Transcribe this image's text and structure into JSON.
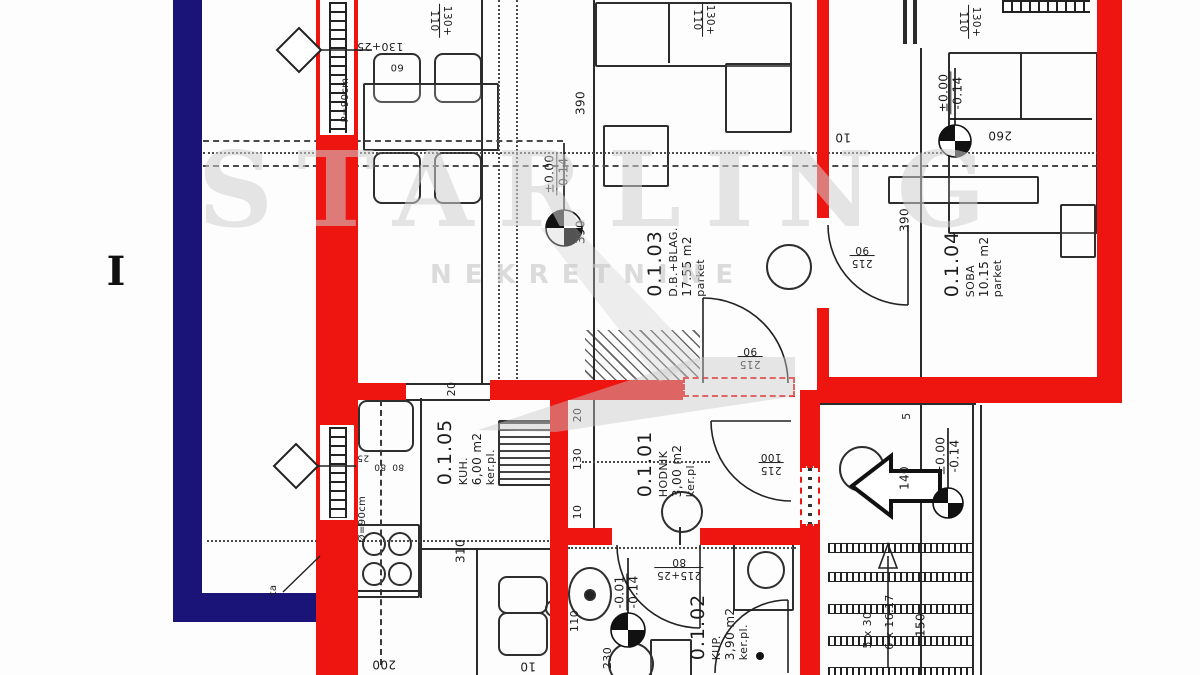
{
  "watermark": {
    "line1": "STARLING",
    "line2": "NEKRETNINE"
  },
  "floor_label": "I",
  "colors": {
    "wall_new": "#ee1511",
    "wall_existing": "#1b1478",
    "line": "#2b2b2b",
    "paper": "#fdfdfd"
  },
  "rooms": [
    {
      "id": "0.1.01",
      "name": "HODNIK",
      "area": "3,00 m2",
      "floor": "ker.pl.",
      "x": 666,
      "y": 464
    },
    {
      "id": "0.1.02",
      "name": "KUP.",
      "area": "3,90 m2",
      "floor": "ker.pl.",
      "x": 719,
      "y": 627
    },
    {
      "id": "0.1.03",
      "name": "D.B.+BLAG.",
      "area": "17.55 m2",
      "floor": "parket",
      "x": 676,
      "y": 262
    },
    {
      "id": "0.1.04",
      "name": "SOBA",
      "area": "10.15 m2",
      "floor": "parket",
      "x": 973,
      "y": 264
    },
    {
      "id": "0.1.05",
      "name": "KUH.",
      "area": "6,00 m2",
      "floor": "ker.pl.",
      "x": 466,
      "y": 452
    }
  ],
  "labels": [
    {
      "t": "130+25",
      "x": 380,
      "y": 46,
      "r": 180,
      "fs": 11
    },
    {
      "t": "60",
      "x": 397,
      "y": 66,
      "r": 180,
      "fs": 10
    },
    {
      "t": "P=90cm",
      "x": 346,
      "y": 100,
      "r": -90,
      "fs": 10
    },
    {
      "t": "390",
      "x": 581,
      "y": 103,
      "r": -90,
      "fs": 12
    },
    {
      "t": "390",
      "x": 581,
      "y": 232,
      "r": -90,
      "fs": 12
    },
    {
      "t": "390",
      "x": 905,
      "y": 220,
      "r": -90,
      "fs": 12
    },
    {
      "t": "260",
      "x": 1000,
      "y": 135,
      "r": 180,
      "fs": 12
    },
    {
      "t": "10",
      "x": 843,
      "y": 137,
      "r": 180,
      "fs": 12
    },
    {
      "t": "20",
      "x": 452,
      "y": 389,
      "r": -90,
      "fs": 11
    },
    {
      "t": "20",
      "x": 578,
      "y": 415,
      "r": -90,
      "fs": 11
    },
    {
      "t": "130",
      "x": 578,
      "y": 459,
      "r": -90,
      "fs": 11
    },
    {
      "t": "10",
      "x": 578,
      "y": 512,
      "r": -90,
      "fs": 11
    },
    {
      "t": "25",
      "x": 363,
      "y": 457,
      "r": 180,
      "fs": 9
    },
    {
      "t": "80",
      "x": 380,
      "y": 466,
      "r": 180,
      "fs": 9
    },
    {
      "t": "80",
      "x": 398,
      "y": 466,
      "r": 180,
      "fs": 9
    },
    {
      "t": "310",
      "x": 461,
      "y": 551,
      "r": -90,
      "fs": 12
    },
    {
      "t": "Ø=90cm",
      "x": 363,
      "y": 519,
      "r": -90,
      "fs": 10
    },
    {
      "t": "5",
      "x": 907,
      "y": 416,
      "r": -90,
      "fs": 11
    },
    {
      "t": "140",
      "x": 905,
      "y": 478,
      "r": -90,
      "fs": 12
    },
    {
      "t": "150",
      "x": 921,
      "y": 625,
      "r": -90,
      "fs": 12
    },
    {
      "t": "5 x 30",
      "x": 868,
      "y": 630,
      "r": -90,
      "fs": 11
    },
    {
      "t": "6 x 16.17",
      "x": 890,
      "y": 622,
      "r": -90,
      "fs": 11
    },
    {
      "t": "110",
      "x": 575,
      "y": 621,
      "r": -90,
      "fs": 11
    },
    {
      "t": "230",
      "x": 608,
      "y": 658,
      "r": -90,
      "fs": 11
    },
    {
      "t": "200",
      "x": 384,
      "y": 664,
      "r": 180,
      "fs": 12
    },
    {
      "t": "10",
      "x": 528,
      "y": 666,
      "r": 180,
      "fs": 12
    },
    {
      "t": "ta",
      "x": 274,
      "y": 590,
      "r": -90,
      "fs": 10
    }
  ],
  "frac_labels": [
    {
      "lines": [
        "110",
        "130+"
      ],
      "x": 440,
      "y": 21,
      "r": 90
    },
    {
      "lines": [
        "110",
        "130+"
      ],
      "x": 703,
      "y": 20,
      "r": 90
    },
    {
      "lines": [
        "110",
        "130+"
      ],
      "x": 969,
      "y": 22,
      "r": 90
    },
    {
      "lines": [
        "90",
        "215"
      ],
      "x": 750,
      "y": 357,
      "r": 180
    },
    {
      "lines": [
        "90",
        "215"
      ],
      "x": 862,
      "y": 256,
      "r": 180
    },
    {
      "lines": [
        "100",
        "215"
      ],
      "x": 771,
      "y": 463,
      "r": 180
    },
    {
      "lines": [
        "80",
        "215+25"
      ],
      "x": 679,
      "y": 568,
      "r": 180
    }
  ],
  "elevations": [
    {
      "lines": [
        "±0.00",
        "-0.14"
      ],
      "x": 557,
      "y": 174
    },
    {
      "lines": [
        "±0.00",
        "-0.14"
      ],
      "x": 951,
      "y": 93
    },
    {
      "lines": [
        "±0.00",
        "-0.14"
      ],
      "x": 948,
      "y": 456
    },
    {
      "lines": [
        "-0.01",
        "-0.14"
      ],
      "x": 627,
      "y": 592
    }
  ]
}
